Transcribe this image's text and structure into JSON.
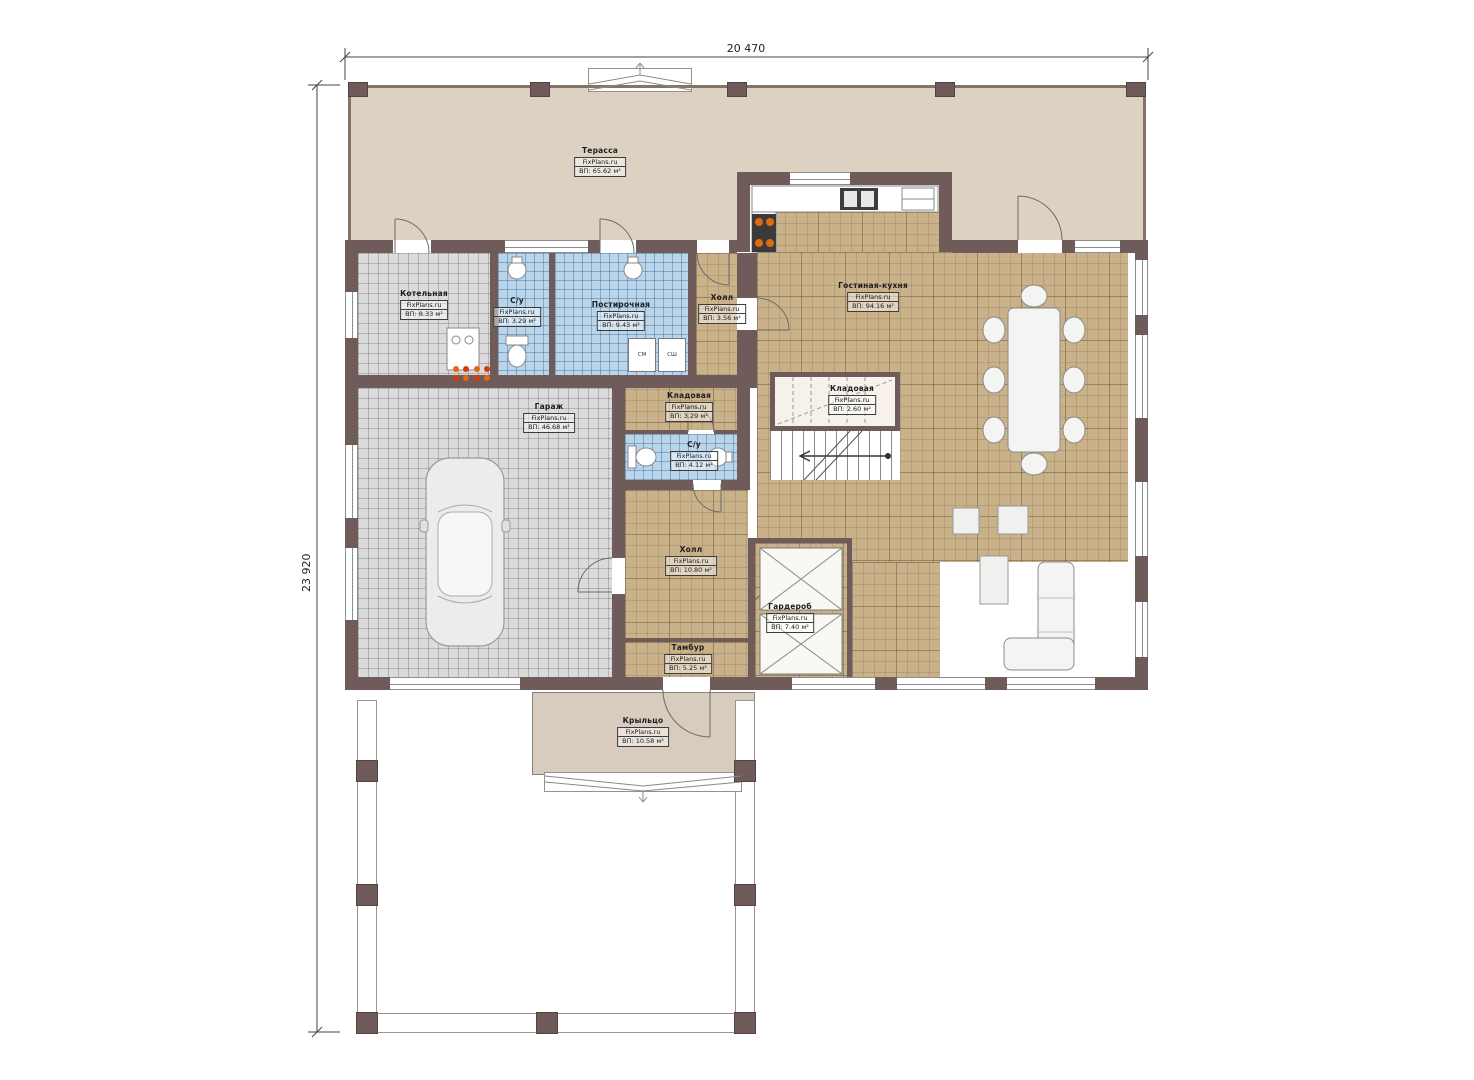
{
  "brand": "FixPlans.ru",
  "dimensions": {
    "width_label": "20 470",
    "height_label": "23 920"
  },
  "rooms": [
    {
      "name": "Терасса",
      "area": "ВП: 65.62 м²"
    },
    {
      "name": "Котельная",
      "area": "ВП: 8.33 м²"
    },
    {
      "name": "С/у",
      "area": "ВП: 3.29 м²"
    },
    {
      "name": "Постирочная",
      "area": "ВП: 9.43 м²"
    },
    {
      "name": "Холл",
      "area": "ВП: 3.56 м²"
    },
    {
      "name": "Гостиная-кухня",
      "area": "ВП: 94.16 м²"
    },
    {
      "name": "Гараж",
      "area": "ВП: 46.68 м²"
    },
    {
      "name": "Кладовая",
      "area": "ВП: 3.29 м²"
    },
    {
      "name": "Кладовая",
      "area": "ВП: 2.60 м²"
    },
    {
      "name": "С/у",
      "area": "ВП: 4.12 м²"
    },
    {
      "name": "Холл",
      "area": "ВП: 10.80 м²"
    },
    {
      "name": "Гардероб",
      "area": "ВП: 7.40 м²"
    },
    {
      "name": "Тамбур",
      "area": "ВП: 5.25 м²"
    },
    {
      "name": "Крыльцо",
      "area": "ВП: 10.58 м²"
    }
  ],
  "appliances": {
    "washer": "СМ",
    "dryer": "СШ"
  },
  "colors": {
    "wall": "#6f5b59",
    "terrace_floor": "#ddd2c2",
    "living_tile": "#c9b28a",
    "garage_tile": "#dbdbdb",
    "bath_tile": "#bad4ea",
    "burner_accent": "#e06a10"
  }
}
